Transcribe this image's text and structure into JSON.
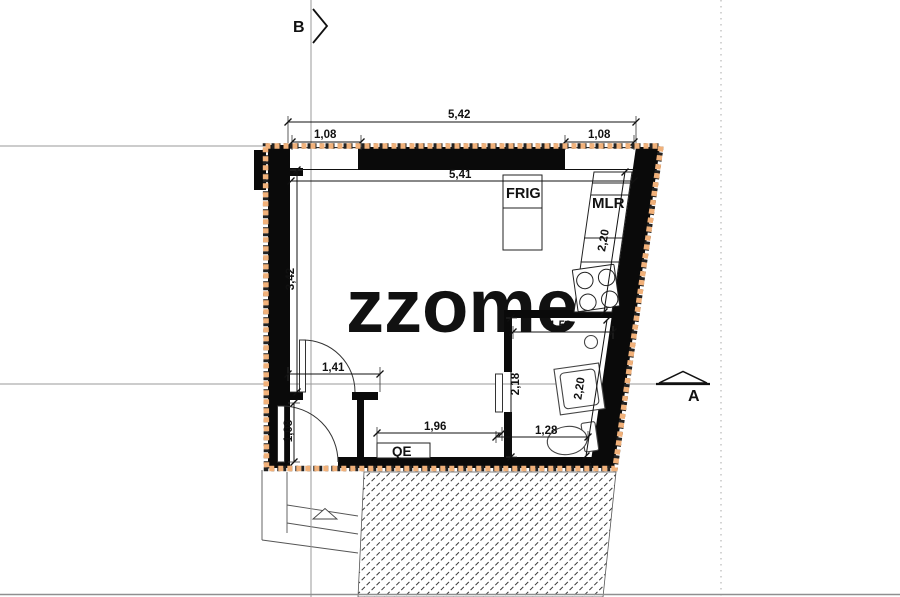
{
  "plan": {
    "watermark": {
      "text": "zzome",
      "registered": "®"
    },
    "section_markers": {
      "top": "B",
      "right": "A"
    },
    "room_labels": {
      "fridge": "FRIG",
      "boiler": "MLR",
      "electrical_panel": "QE"
    },
    "dimensions": {
      "top_total": "5,42",
      "window_left": "1,08",
      "window_right": "1,08",
      "interior_width": "5,41",
      "room_depth": "3,42",
      "interior_door": "1,41",
      "entry_door": "1,08",
      "alcove_width": "1,96",
      "counter_length": "2,20",
      "bath_width": "1,59",
      "bath_depth": "2,18",
      "bath_diagonal": "2,20",
      "wc_width": "1,28"
    },
    "colors": {
      "insulation": "#f1b17a",
      "wall": "#0a0a0a",
      "axis": "#9a9a9a",
      "watermark": "#ededed"
    }
  }
}
